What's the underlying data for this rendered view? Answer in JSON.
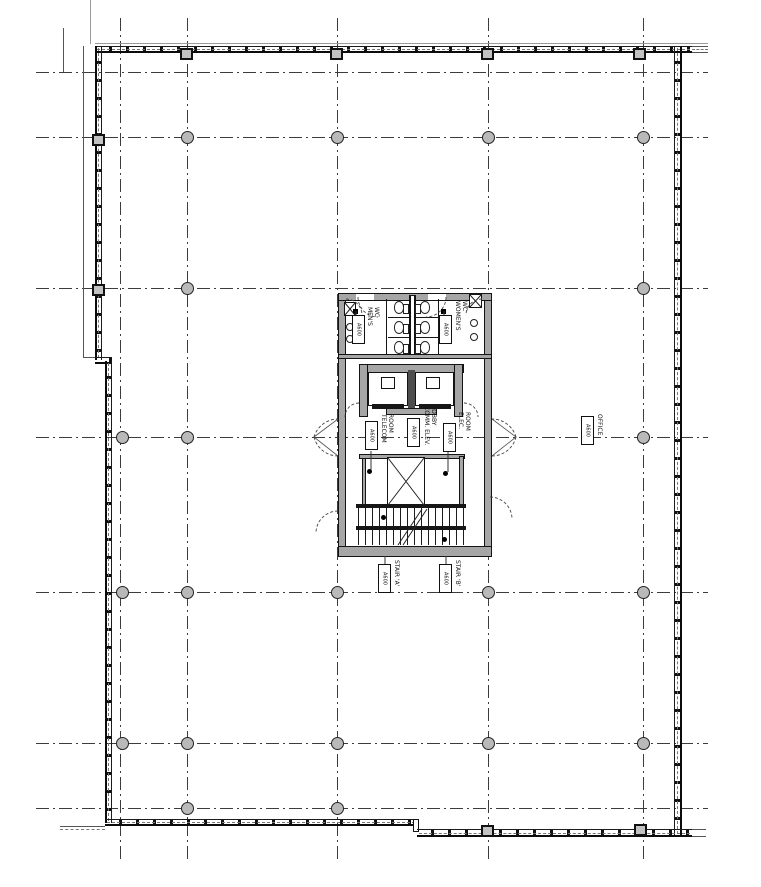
{
  "drawing": {
    "rooms": {
      "mens_wc": {
        "label": "MEN'S\nWC",
        "tag": "A600"
      },
      "womens_wc": {
        "label": "WOMEN'S\nWC",
        "tag": "A600"
      },
      "telecom_room": {
        "label": "TELECOM\nROOM",
        "tag": "A600"
      },
      "comm_elev_lobby": {
        "label": "COMM. ELEV.\nLOBBY",
        "tag": "A600"
      },
      "elec_room": {
        "label": "ELEC.\nROOM",
        "tag": "A600"
      },
      "office": {
        "label": "OFFICE",
        "tag": "A600"
      },
      "stair_a": {
        "label": "STAIR 'A'",
        "tag": "A600"
      },
      "stair_b": {
        "label": "STAIR 'B'",
        "tag": "A600"
      }
    },
    "colors": {
      "wall_fill": "#a6a6a6",
      "column_fill": "#b9b9b9",
      "line": "#141414",
      "grid_line": "#3c3c3c"
    }
  },
  "plan_geometry": {
    "grid": {
      "vertical_x": [
        120,
        187,
        337,
        488,
        643
      ],
      "v_extent": [
        18,
        860
      ],
      "horizontal_y": [
        72,
        137,
        288,
        437,
        592,
        743,
        808
      ],
      "h_extent": [
        36,
        708
      ]
    },
    "columns": {
      "round": [
        [
          187,
          137
        ],
        [
          337,
          137
        ],
        [
          488,
          137
        ],
        [
          643,
          137
        ],
        [
          187,
          288
        ],
        [
          643,
          288
        ],
        [
          122,
          437
        ],
        [
          187,
          437
        ],
        [
          643,
          437
        ],
        [
          122,
          592
        ],
        [
          187,
          592
        ],
        [
          337,
          592
        ],
        [
          488,
          592
        ],
        [
          643,
          592
        ],
        [
          122,
          743
        ],
        [
          187,
          743
        ],
        [
          337,
          743
        ],
        [
          488,
          743
        ],
        [
          643,
          743
        ],
        [
          187,
          808
        ],
        [
          337,
          808
        ]
      ],
      "square": [
        [
          187,
          54
        ],
        [
          337,
          54
        ],
        [
          488,
          54
        ],
        [
          640,
          54
        ],
        [
          99,
          140
        ],
        [
          99,
          290
        ],
        [
          488,
          831
        ],
        [
          641,
          830
        ]
      ]
    }
  }
}
